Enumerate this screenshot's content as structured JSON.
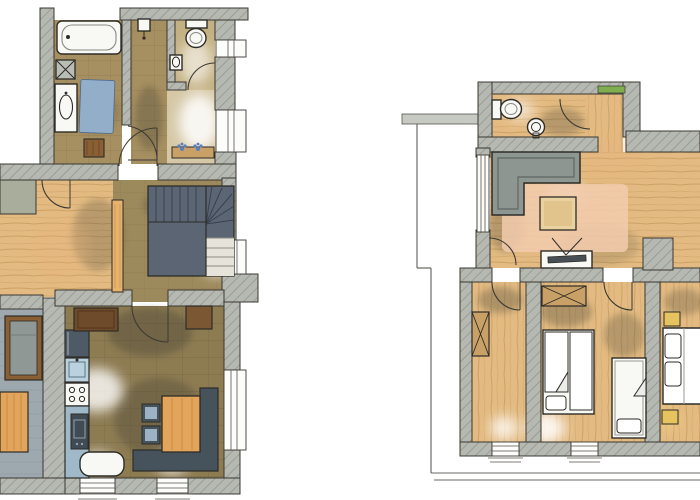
{
  "meta": {
    "title": "hand-painted apartment floor plans, two levels, watercolor style, no text labels",
    "canvas": {
      "width": 700,
      "height": 500
    }
  },
  "palette": {
    "paper": "#ffffff",
    "ink": "#2e2c27",
    "wall": "#b5b9b1",
    "wall_hatch": "#8e928b",
    "wood_light": "#e3bb82",
    "wood_stroke": "#c3965a",
    "bath_floor": "#a68f60",
    "bath_grid": "#8b7750",
    "hall_floor": "#9d8a5c",
    "kitchen_floor": "#8d7b52",
    "kitchen_grid": "#6a5c3c",
    "stair_tread": "#5b6573",
    "stair_light": "#e6e3db",
    "terrace_floor": "#9ea8af",
    "terrace_line": "#87939b",
    "water_blue": "#93aec9",
    "counter_blue": "#9fb9c9",
    "sink_blue": "#b9d2de",
    "appliance_dark": "#4e5a66",
    "bench_dark": "#46525c",
    "table_orange": "#e2a55b",
    "panel_orange": "#e7b26b",
    "sofa_gray": "#8e9692",
    "sofa_line": "#5f6763",
    "rug_pink": "#f2cbae",
    "coffee_table": "#ead2a0",
    "fixture_white": "#f8f8f5",
    "wardrobe_tan": "#c9a167",
    "sideboard_brown": "#6e4c2b",
    "wood_dark": "#8a5f33",
    "plant_green": "#7fae4e",
    "flower_blue": "#5d7fc0",
    "shadow_olive": "#4d4a38",
    "glow_white": "#ffffff"
  },
  "plans": [
    {
      "id": "upper-level-left",
      "position": "left",
      "rooms": [
        {
          "name": "bathroom",
          "fixtures": [
            "bathtub",
            "washing-machine",
            "vanity-sink",
            "bath-mat-blue",
            "wood-stool"
          ]
        },
        {
          "name": "hallway-top",
          "fixtures": [
            "ceiling-lamp"
          ]
        },
        {
          "name": "wc",
          "fixtures": [
            "toilet",
            "hand-basin",
            "door-arc"
          ]
        },
        {
          "name": "entrance",
          "fixtures": [
            "flower-bench",
            "two-windows"
          ]
        },
        {
          "name": "stair-hall",
          "fixtures": [
            "winder-staircase",
            "window"
          ]
        },
        {
          "name": "wood-floor-room",
          "fixtures": [
            "plank-floor",
            "door-arc",
            "sliding-panel"
          ]
        },
        {
          "name": "terrace",
          "fixtures": [
            "lounger",
            "garden-table"
          ]
        },
        {
          "name": "kitchen-dining",
          "fixtures": [
            "fridge",
            "sink-cabinet",
            "stove-4-burners",
            "oven",
            "counter",
            "window-bench",
            "sideboard-left",
            "sideboard-right",
            "dining-table",
            "corner-bench",
            "chair",
            "chair",
            "two-windows",
            "side-window"
          ]
        }
      ]
    },
    {
      "id": "main-level-right",
      "position": "right",
      "rooms": [
        {
          "name": "shower-wc",
          "fixtures": [
            "toilet",
            "round-basin",
            "door-arc",
            "green-window-sill"
          ]
        },
        {
          "name": "living-room",
          "fixtures": [
            "corner-sofa",
            "pink-rug",
            "coffee-table",
            "tv-sideboard",
            "balcony-glass-door",
            "door-arc",
            "chimney-block"
          ]
        },
        {
          "name": "bedroom-1",
          "fixtures": [
            "wardrobe-crossed",
            "window",
            "door-arc"
          ]
        },
        {
          "name": "bedroom-2",
          "fixtures": [
            "wardrobe-crossed",
            "double-bed",
            "cot",
            "window",
            "door-arc"
          ]
        },
        {
          "name": "bedroom-3",
          "fixtures": [
            "double-bed",
            "nightstand",
            "nightstand"
          ]
        },
        {
          "name": "balcony",
          "fixtures": [
            "parapet",
            "railing-outline"
          ]
        }
      ]
    }
  ]
}
